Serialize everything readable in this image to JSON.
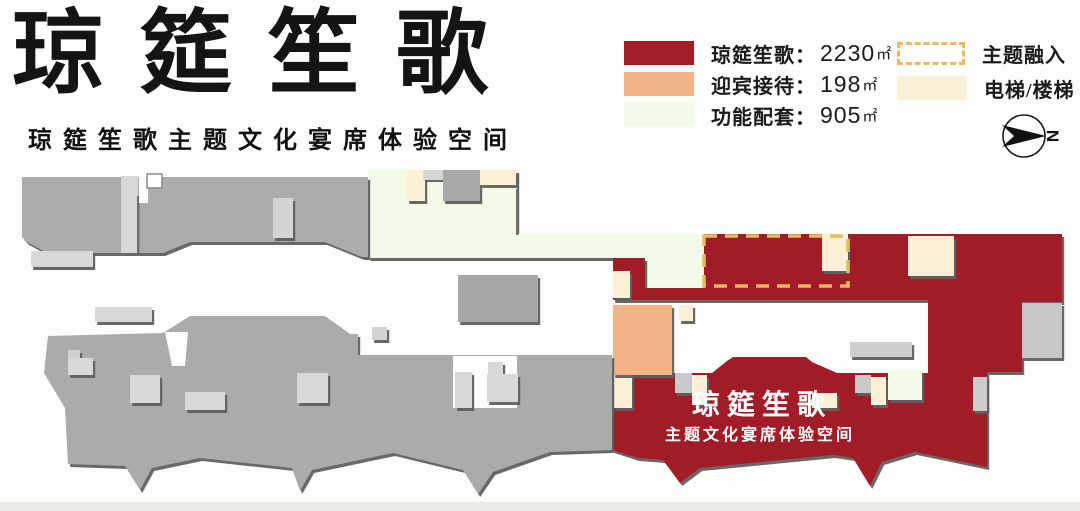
{
  "header": {
    "title": "琼筵笙歌",
    "subtitle": "琼筵笙歌主题文化宴席体验空间"
  },
  "legend": {
    "areas": [
      {
        "label": "琼筵笙歌：",
        "value": "2230",
        "unit": "㎡",
        "color": "#A11D28"
      },
      {
        "label": "迎宾接待：",
        "value": "198",
        "unit": "㎡",
        "color": "#F4B287"
      },
      {
        "label": "功能配套：",
        "value": "905",
        "unit": "㎡",
        "color": "#F3FAE8"
      }
    ],
    "markers": [
      {
        "label": "主题融入",
        "style": "dashed",
        "color": "#ECB95D"
      },
      {
        "label": "电梯/楼梯",
        "style": "solid",
        "color": "#FAF0D6"
      }
    ]
  },
  "compass": {
    "label": "N"
  },
  "plan": {
    "hall_title": "琼筵笙歌",
    "hall_subtitle": "主题文化宴席体验空间"
  },
  "colors": {
    "banquet_red": "#A11D28",
    "reception_orange": "#F4B287",
    "function_green": "#F3FAE8",
    "elevator_cream": "#FAF0D6",
    "theme_dash": "#ECB95D",
    "building_gray": "#ACACAC",
    "block_light_gray": "#D8D8D8",
    "shadow": "#5E5E5E"
  }
}
